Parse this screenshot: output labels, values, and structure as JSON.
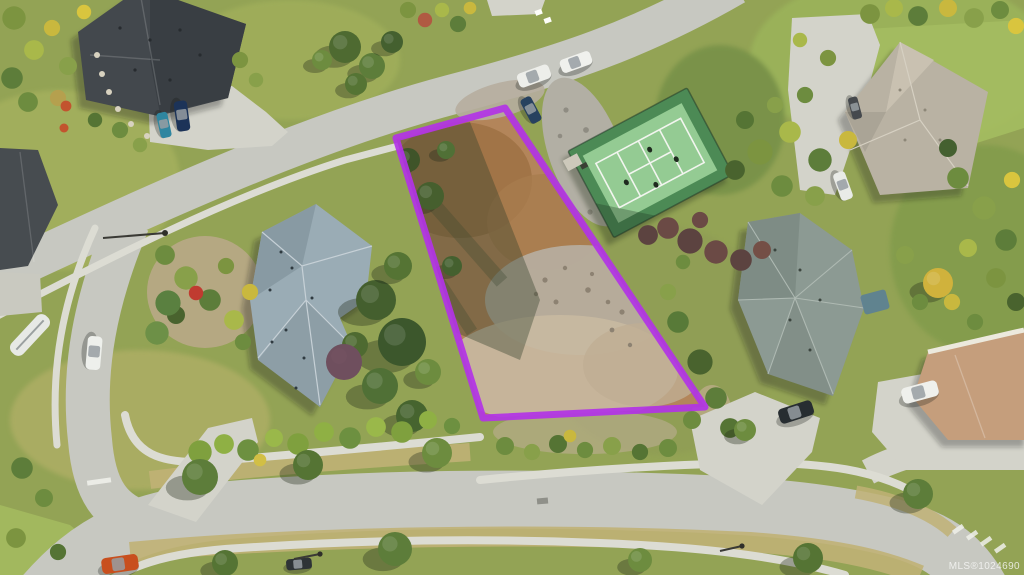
{
  "scene": {
    "type": "aerial-photograph",
    "description": "Aerial drone view of a vacant residential building lot outlined in purple, bordered by curving streets, neighbouring houses, gardens and a private tennis court"
  },
  "watermark": {
    "text": "MLS®1024690"
  },
  "lot_outline": {
    "points": "396,138 505,108 705,407 483,418",
    "color": "#b233e6",
    "stroke_width": 7
  },
  "palette": {
    "ground": "#93a355",
    "lawn": "#9cb159",
    "lawn_bright": "#a4bc60",
    "dry_grass": "#c0b176",
    "road": "#c7c8c1",
    "sidewalk": "#dcdcd3",
    "driveway": "#d3d3ca",
    "dirt": "#b3855a",
    "dirt_dark": "#9e7245",
    "gravel": "#b6ad9e",
    "dust_light": "#c8b9a1",
    "rock": "#b2afa4",
    "roof_dark": "#43484d",
    "roof_dark2": "#393e43",
    "roof_blue": "#9aacb5",
    "roof_blue_dark": "#83969f",
    "roof_green": "#8c9a93",
    "roof_green_dark": "#7b8a83",
    "roof_warm": "#b9b2a3",
    "roof_warm_light": "#c9c2b2",
    "roof_tan": "#c59e7c",
    "trim_white": "#ece9dd",
    "court_outer": "#4c8a55",
    "court_inner": "#94cb93",
    "court_line": "#f2f5ef",
    "outline_purple": "#b233e6"
  }
}
